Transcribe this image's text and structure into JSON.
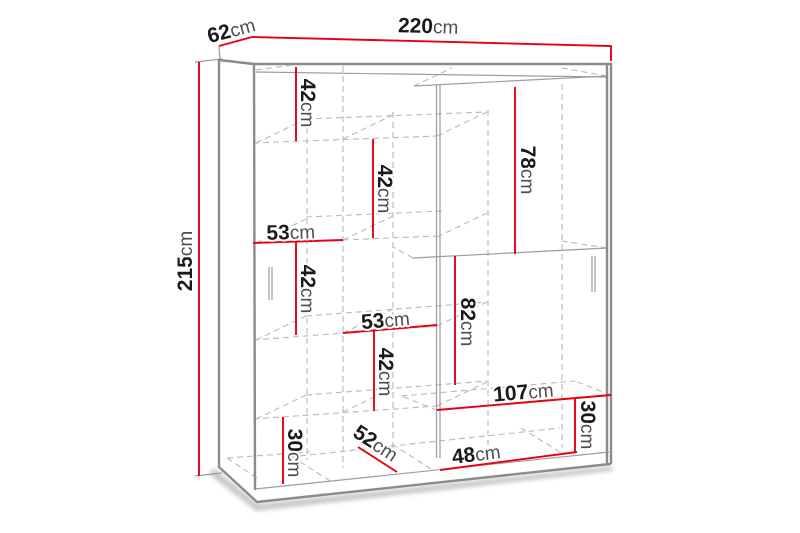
{
  "diagram": {
    "type": "furniture-dimension-diagram",
    "subject": "two sliding-door wardrobe with interior shelves",
    "unit": "cm",
    "colors": {
      "dimension_line": "#e8000f",
      "outline": "#8b8b8b",
      "hidden_line": "#b9b9b9",
      "number_text": "#1a1a1a",
      "unit_text": "#4d4d4d",
      "background": "#ffffff"
    },
    "overall_dimensions": {
      "width": {
        "value": "220",
        "unit": "cm"
      },
      "depth": {
        "value": "62",
        "unit": "cm"
      },
      "height": {
        "value": "215",
        "unit": "cm"
      }
    },
    "internal_dimensions": [
      {
        "id": "top-left-shelf-height",
        "value": "42",
        "unit": "cm"
      },
      {
        "id": "upper-middle-shelf-height",
        "value": "42",
        "unit": "cm"
      },
      {
        "id": "left-shelf-width",
        "value": "53",
        "unit": "cm"
      },
      {
        "id": "middle-left-shelf-height",
        "value": "42",
        "unit": "cm"
      },
      {
        "id": "middle-shelf-width",
        "value": "53",
        "unit": "cm"
      },
      {
        "id": "lower-middle-shelf-height",
        "value": "42",
        "unit": "cm"
      },
      {
        "id": "right-upper-section-height",
        "value": "78",
        "unit": "cm"
      },
      {
        "id": "right-middle-section-height",
        "value": "82",
        "unit": "cm"
      },
      {
        "id": "bottom-right-shelf-width",
        "value": "107",
        "unit": "cm"
      },
      {
        "id": "bottom-right-shelf-height",
        "value": "30",
        "unit": "cm"
      },
      {
        "id": "bottom-shelf-width",
        "value": "48",
        "unit": "cm"
      },
      {
        "id": "bottom-left-shelf-height",
        "value": "30",
        "unit": "cm"
      },
      {
        "id": "bottom-shelf-depth",
        "value": "52",
        "unit": "cm"
      }
    ]
  }
}
